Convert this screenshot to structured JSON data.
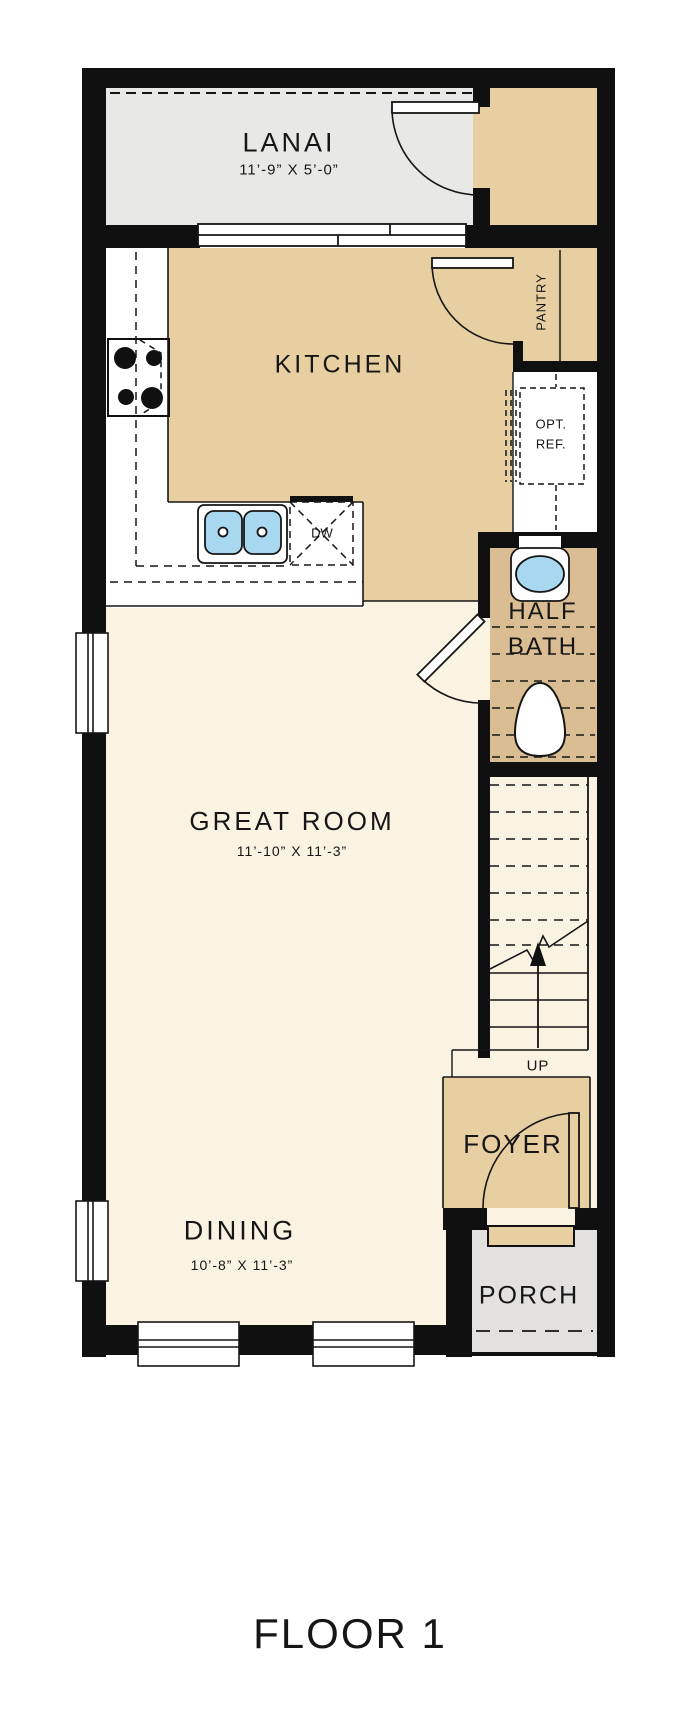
{
  "title": "FLOOR 1",
  "rooms": {
    "lanai": {
      "name": "LANAI",
      "dims": "11’-9” X 5’-0”"
    },
    "kitchen": {
      "name": "KITCHEN"
    },
    "pantry": {
      "name": "PANTRY"
    },
    "ref": {
      "line1": "OPT.",
      "line2": "REF."
    },
    "half_bath": {
      "line1": "HALF",
      "line2": "BATH"
    },
    "great_room": {
      "name": "GREAT ROOM",
      "dims": "11’-10” X 11’-3”"
    },
    "dining": {
      "name": "DINING",
      "dims": "10’-8” X 11’-3”"
    },
    "foyer": {
      "name": "FOYER"
    },
    "porch": {
      "name": "PORCH"
    },
    "stairs": {
      "up_label": "UP"
    },
    "dishwasher": {
      "label": "DW"
    }
  },
  "colors": {
    "wall": "#101010",
    "interior_tan": "#e8cfa2",
    "bath_tan": "#dabd92",
    "floor_cream": "#fbf3e2",
    "lanai_gray": "#e8e8e7",
    "porch_gray": "#e2e1e0",
    "fixture_blue": "#a8d8f0",
    "line": "#161616"
  }
}
